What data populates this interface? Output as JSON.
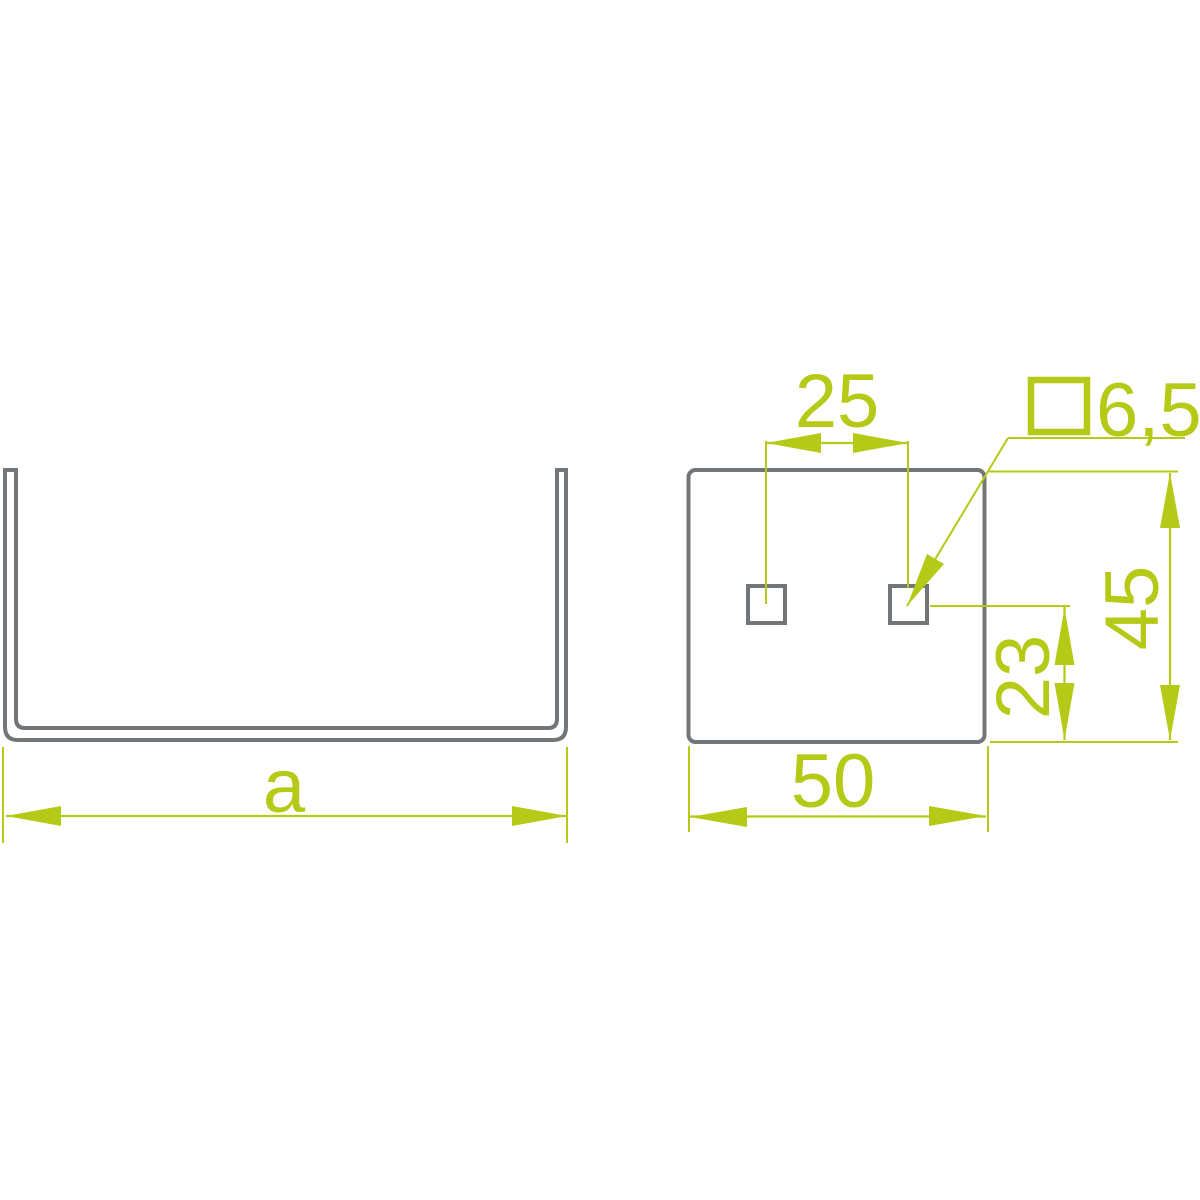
{
  "drawing": {
    "type_note": "technical dimension drawing, two views",
    "colors": {
      "dimension": "#b5c917",
      "outline": "#737678",
      "background": "#ffffff"
    },
    "front_view": {
      "part": "u-channel-profile",
      "dim_width_label": "a"
    },
    "side_view": {
      "part": "channel-side-plate",
      "dim_hole_spacing": "25",
      "dim_plate_width": "50",
      "dim_hole_center_from_bottom": "23",
      "dim_plate_height": "45",
      "hole_size_value": "6,5",
      "hole_size_symbol": "square"
    }
  }
}
